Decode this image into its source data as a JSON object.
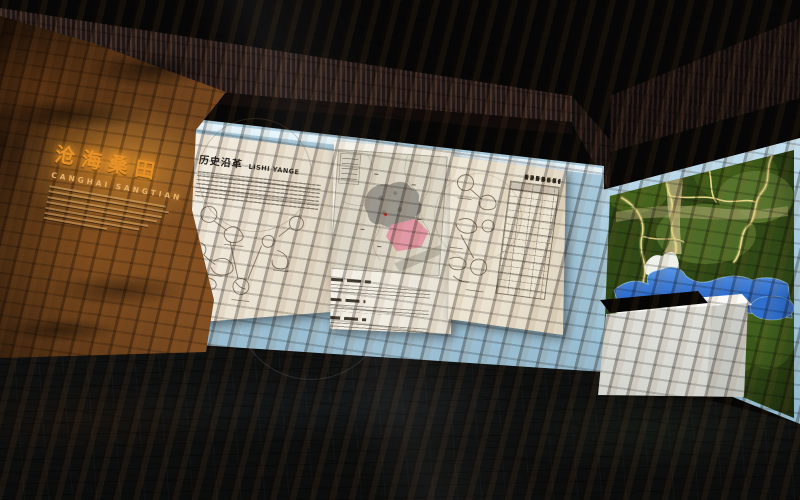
{
  "meta": {
    "description": "3D rendering of a museum exhibition hall, history section",
    "lighting": "dark hall with backlit display walls"
  },
  "rock_wall": {
    "title_cn": "沧海桑田",
    "title_pinyin": "CANGHAI SANGTIAN"
  },
  "center_wall": {
    "intro_panel": {
      "title_cn": "历史沿革",
      "title_latin": "LISHI YANGE"
    },
    "map_panel": {
      "caption_blocks": 3
    },
    "table_panel": {
      "table_rows_visible": 16,
      "table_columns_visible": 4
    }
  },
  "colors": {
    "rock_base": "#8d5727",
    "rock_title_glow": "#e89128",
    "wall_blue": "#a2c5d8",
    "panel_cream": "#f0e9db",
    "map_highlight_pink": "#e294a3",
    "terrain_green": "#3c5a1a",
    "terrain_route_yellow": "#e8d88a",
    "water_blue": "#2f6fce",
    "grille_brown": "#3c2c28",
    "floor_dark": "#131414",
    "pedestal_white": "#eeefec"
  }
}
